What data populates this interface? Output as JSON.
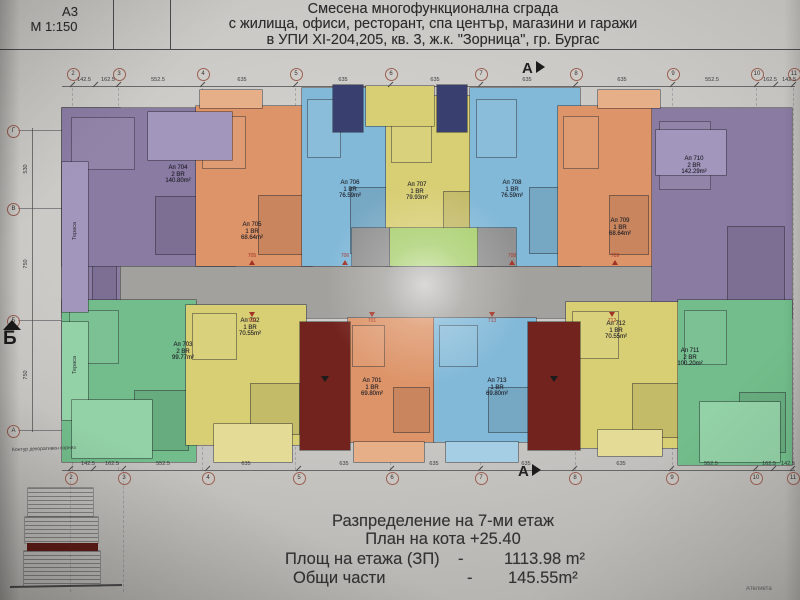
{
  "sheet": {
    "format": "A3",
    "scale": "М 1:150",
    "title_lines": [
      "Смесена многофункционална сграда",
      "с жилища, офиси, ресторант, спа център, магазини и  гаражи",
      "в УПИ XI-204,205, кв. 3, ж.к. \"Зорница\", гр. Бургас"
    ]
  },
  "footer": {
    "floor_line": "Разпределение на 7-ми  етаж",
    "level_line": "План на кота  +25.40",
    "rows": [
      {
        "label": "Площ на етажа (ЗП)",
        "sep": "-",
        "value": "1113.98 m²"
      },
      {
        "label": "Общи части",
        "sep": "-",
        "value": "145.55m²"
      }
    ]
  },
  "axes": {
    "top_columns": [
      "2",
      "3",
      "4",
      "5",
      "6",
      "7",
      "8",
      "9",
      "10",
      "11"
    ],
    "bottom_columns": [
      "2",
      "3",
      "4",
      "5",
      "6",
      "7",
      "8",
      "9",
      "10",
      "11"
    ],
    "top_dims": [
      "142.5",
      "162.5",
      "552.5",
      "635",
      "635",
      "635",
      "635",
      "635",
      "552.5",
      "162.5",
      "142.5"
    ],
    "bottom_dims": [
      "142.5",
      "162.5",
      "552.5",
      "635",
      "635",
      "635",
      "635",
      "635",
      "552.5",
      "162.5",
      "142.5"
    ],
    "left_rows": [
      "Г",
      "В",
      "Б",
      "А"
    ],
    "left_dims": [
      "530",
      "750",
      "750"
    ],
    "section_a": "А",
    "section_b": "Б"
  },
  "apartments": [
    {
      "label": "Ап 704",
      "br": "2 BR",
      "area": "140.80m²"
    },
    {
      "label": "Ап 705",
      "br": "1 BR",
      "area": "68.64m²"
    },
    {
      "label": "Ап 706",
      "br": "1 BR",
      "area": "76.59m²"
    },
    {
      "label": "Ап 707",
      "br": "1 BR",
      "area": "79.93m²"
    },
    {
      "label": "Ап 708",
      "br": "1 BR",
      "area": "76.59m²"
    },
    {
      "label": "Ап 709",
      "br": "1 BR",
      "area": "68.64m²"
    },
    {
      "label": "Ап 710",
      "br": "2 BR",
      "area": "142.29m²"
    },
    {
      "label": "Ап 703",
      "br": "2 BR",
      "area": "99.77m²"
    },
    {
      "label": "Ап 702",
      "br": "1 BR",
      "area": "70.55m²"
    },
    {
      "label": "Ап 701",
      "br": "1 BR",
      "area": "69.80m²"
    },
    {
      "label": "Ап 713",
      "br": "1 BR",
      "area": "69.80m²"
    },
    {
      "label": "Ап 712",
      "br": "1 BR",
      "area": "70.55m²"
    },
    {
      "label": "Ап 711",
      "br": "2 BR",
      "area": "100.20m²"
    }
  ],
  "entrance_markers": {
    "top": [
      "705",
      "706",
      "708",
      "709"
    ],
    "bottom": [
      "702",
      "701",
      "713",
      "712"
    ]
  },
  "annotations": {
    "terrace": "Тераса",
    "cornice": "Контур декоративен корниз",
    "corner": "Ателиета"
  },
  "colors": {
    "purple": "#8a7ba3",
    "purple_light": "#a396bc",
    "orange": "#dd9468",
    "orange_light": "#e7af87",
    "blue": "#82b9d8",
    "blue_light": "#a5cee5",
    "yellow": "#d8ce74",
    "yellow_light": "#e4db96",
    "green": "#72bd8b",
    "green_light": "#93d1a6",
    "lime": "#a8cf6d",
    "navy": "#39406f",
    "dark_red": "#73231d",
    "corridor": "#a3a19d",
    "shaft_gray": "#919090",
    "axis_red": "#9a5f52"
  }
}
